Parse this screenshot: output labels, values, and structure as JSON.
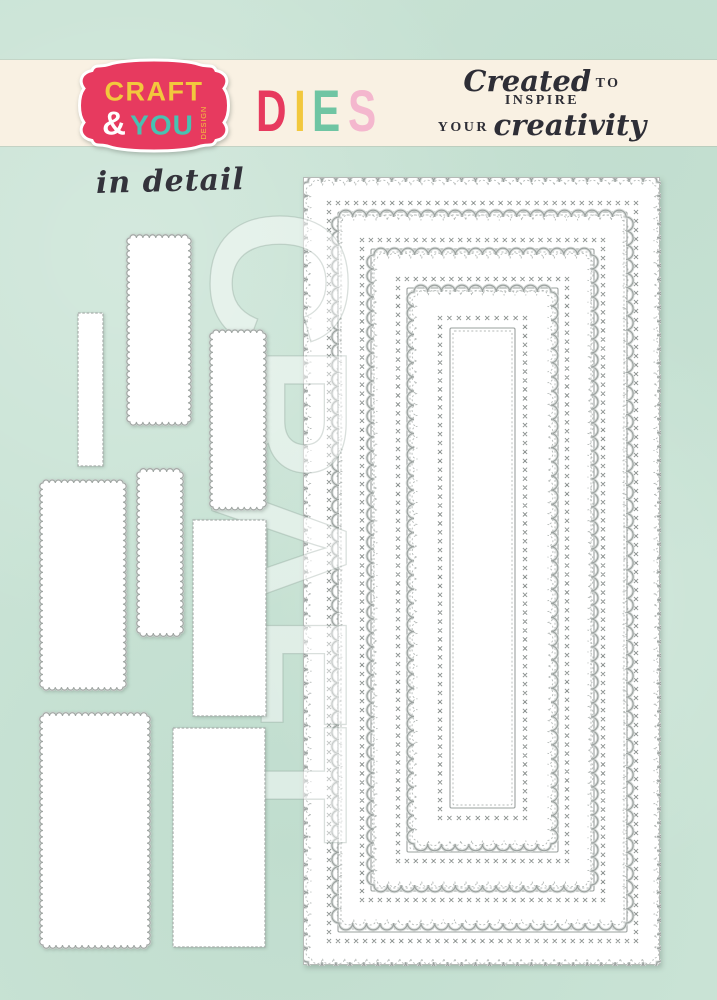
{
  "page": {
    "background": "#c9e3d5"
  },
  "banner": {
    "background": "#f9f1e3",
    "logo": {
      "word1": "CRAFT",
      "amp": "&",
      "word2": "YOU",
      "vertical": "DESIGN",
      "badge_color": "#e73a5f",
      "badge_outline": "#ffffff",
      "word1_color": "#f2c83d",
      "amp_color": "#ffffff",
      "word2_color": "#49c1b1",
      "vertical_color": "#f2c83d"
    },
    "dies_letters": [
      {
        "ch": "D",
        "color": "#e73a5e"
      },
      {
        "ch": "I",
        "color": "#f2c83d"
      },
      {
        "ch": "E",
        "color": "#6fc5a3"
      },
      {
        "ch": "S",
        "color": "#f4b7ce"
      }
    ],
    "tagline": {
      "script1": "Created",
      "caps1": "to inspire",
      "caps2": "your",
      "script2": "creativity",
      "color": "#2e2e36"
    }
  },
  "detail_label": {
    "text": "in detail",
    "color": "#33333b"
  },
  "watermark": {
    "text": "CRAFT"
  },
  "die_panel": {
    "x": 303,
    "y": 177,
    "width": 357,
    "height": 788,
    "line_color": "#9aa09e",
    "soft_color": "#d7dbd9",
    "dash_color": "#b4b9b7",
    "stitch_color": "#8a908e",
    "frames": [
      {
        "outer": [
          4,
          4,
          349,
          780
        ],
        "x_inset": 21,
        "inner_inset": 30
      },
      {
        "outer": [
          35,
          39,
          287,
          706
        ],
        "x_inset": 23,
        "inner_inset": 32
      },
      {
        "outer": [
          70,
          77,
          217,
          630
        ],
        "x_inset": 24,
        "inner_inset": 33
      },
      {
        "outer": [
          110,
          114,
          137,
          552
        ],
        "x_inset": 26,
        "inner_inset": 36
      }
    ]
  },
  "sample_dies": [
    {
      "x": 130,
      "y": 238,
      "w": 58,
      "h": 184,
      "edge": "scalloped"
    },
    {
      "x": 78,
      "y": 313,
      "w": 25,
      "h": 153,
      "edge": "stitched"
    },
    {
      "x": 213,
      "y": 333,
      "w": 50,
      "h": 174,
      "edge": "scalloped"
    },
    {
      "x": 140,
      "y": 472,
      "w": 40,
      "h": 161,
      "edge": "scalloped"
    },
    {
      "x": 43,
      "y": 483,
      "w": 80,
      "h": 204,
      "edge": "scalloped"
    },
    {
      "x": 193,
      "y": 520,
      "w": 73,
      "h": 196,
      "edge": "stitched"
    },
    {
      "x": 43,
      "y": 716,
      "w": 104,
      "h": 229,
      "edge": "scalloped"
    },
    {
      "x": 173,
      "y": 728,
      "w": 92,
      "h": 219,
      "edge": "stitched"
    }
  ]
}
